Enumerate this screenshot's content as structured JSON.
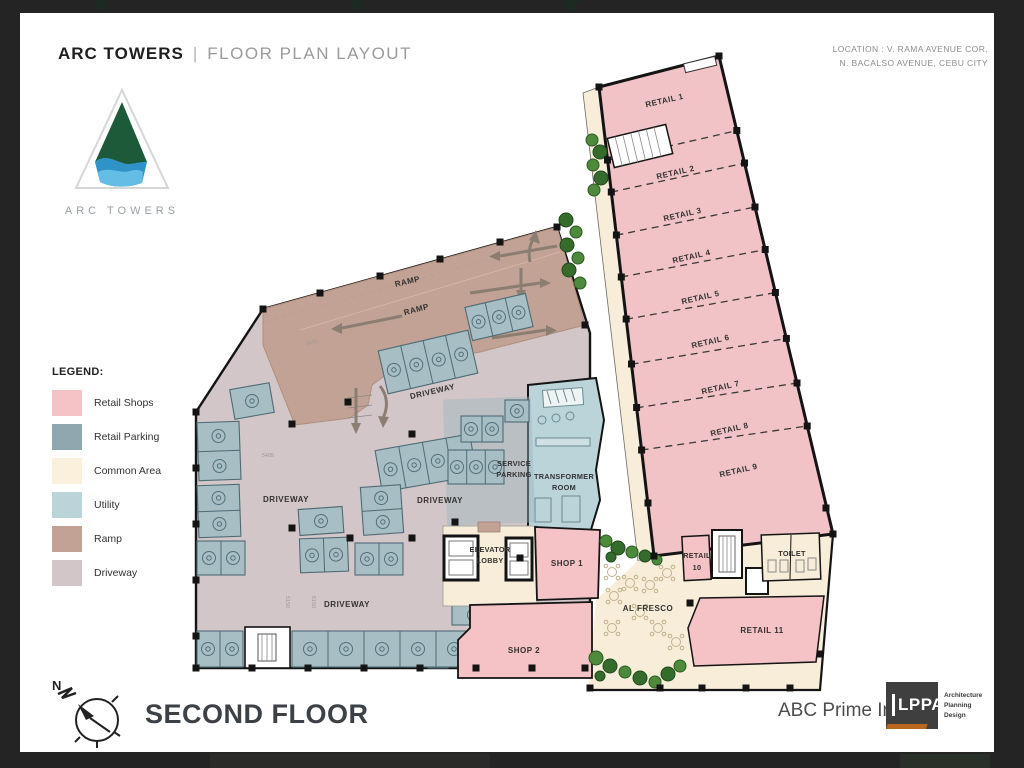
{
  "header": {
    "brand": "ARC TOWERS",
    "divider": "|",
    "subtitle": "FLOOR PLAN LAYOUT",
    "location_line1": "LOCATION : V. RAMA AVENUE COR.",
    "location_line2": "N. BACALSO AVENUE, CEBU CITY"
  },
  "logo": {
    "wordmark": "ARC TOWERS"
  },
  "legend": {
    "title": "LEGEND:",
    "items": [
      {
        "label": "Retail Shops",
        "color": "#F5C2C6",
        "style": "background:#F5C2C6"
      },
      {
        "label": "Retail Parking",
        "color": "#8FA7AF",
        "style": "background:#8FA7AF"
      },
      {
        "label": "Common Area",
        "color": "#FAF0DB",
        "style": "background:#FAF0DB"
      },
      {
        "label": "Utility",
        "color": "#BAD4DA",
        "style": "background:#BAD4DA"
      },
      {
        "label": "Ramp",
        "color": "#C1A295",
        "style": "background:#C1A295"
      },
      {
        "label": "Driveway",
        "color": "#D2C6C8",
        "style": "background:#D2C6C8"
      }
    ]
  },
  "plan": {
    "retail_units": [
      "RETAIL 1",
      "RETAIL 2",
      "RETAIL 3",
      "RETAIL 4",
      "RETAIL 5",
      "RETAIL 6",
      "RETAIL 7",
      "RETAIL 8",
      "RETAIL 9"
    ],
    "rooms": {
      "retail10": [
        "RETAIL",
        "10"
      ],
      "retail11": "RETAIL 11",
      "toilet": "TOILET",
      "al_fresco": "AL FRESCO",
      "shop1": "SHOP 1",
      "shop2": "SHOP 2",
      "elevator_lobby": [
        "ELEVATOR",
        "LOBBY"
      ],
      "service_parking": [
        "SERVICE",
        "PARKING"
      ],
      "transformer_room": [
        "TRANSFORMER",
        "ROOM"
      ]
    },
    "ramp_labels": [
      "RAMP",
      "RAMP"
    ],
    "driveway_labels": [
      "DRIVEWAY",
      "DRIVEWAY",
      "DRIVEWAY",
      "DRIVEWAY"
    ],
    "dimensions": [
      "3475",
      "5405",
      "5150",
      "6150"
    ]
  },
  "footer": {
    "compass_n": "N",
    "floor_title": "SECOND FLOOR",
    "client": "ABC Prime Inc.",
    "firm_acronym": "LPPA",
    "firm_tagline": [
      "Architecture",
      "Planning",
      "Design"
    ]
  }
}
